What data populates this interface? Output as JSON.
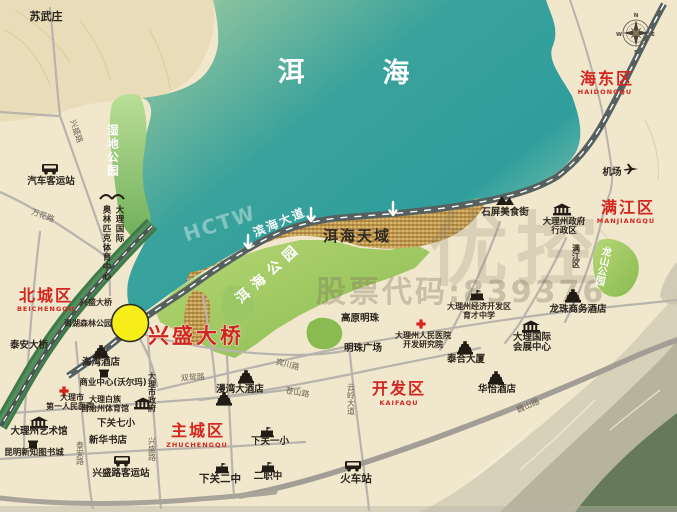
{
  "colors": {
    "district_red": "#d4261f",
    "lake_teal": "#2f9e9c",
    "park_green": "#8fbf5c",
    "marker_yellow": "#f7ee18",
    "highway_dark": "#55605f"
  },
  "lake": {
    "char1": "洱",
    "char2": "海"
  },
  "districts": {
    "haidong": {
      "name": "海东区",
      "pinyin": "HAIDONGQU"
    },
    "manjiang": {
      "name": "满江区",
      "pinyin": "MANJIANGQU"
    },
    "beicheng": {
      "name": "北城区",
      "pinyin": "BEICHENGQU"
    },
    "zhucheng": {
      "name": "主城区",
      "pinyin": "ZHUCHENGQU"
    },
    "kaifa": {
      "name": "开发区",
      "pinyin": "KAIFAQU"
    }
  },
  "parks": {
    "wetland": "湿地公园",
    "erhai_park": "洱海公园",
    "longshan": "龙山公园"
  },
  "highlight": {
    "bridge": "兴盛大桥",
    "erhai_tianyu": "洱海天域"
  },
  "roads": {
    "binhai_avenue": "滨海大道",
    "xingsheng_rd_n": "兴盛路",
    "wanhua_rd": "万花路",
    "taian_rd": "泰安路",
    "xingsheng_rd_s": "兴盛路",
    "shuangyuan_rd": "双鸳路",
    "binchuan_rd": "宾川路",
    "cangshan_rd": "苍山路",
    "yunling_ave": "云岭大道",
    "weishan_rd": "巍山路"
  },
  "pois": {
    "suwuzhuang": "苏武庄",
    "bus_station": "汽车客运站",
    "olympic_line1": "大理国际",
    "olympic_line2": "奥林匹克体育中心",
    "xingsheng_bridge_small": "兴盛大桥",
    "forest_park": "洱湖森林公园",
    "taian_bridge": "泰安大桥",
    "haiwan_hotel": "海湾酒店",
    "business_center": "商业中心(沃尔玛)",
    "hospital1_line1": "大理市",
    "hospital1_line2": "第一人民医院",
    "gym_line1": "大理白族",
    "gym_line2": "自治州体育馆",
    "city_gov": "大理市政府",
    "xiaguan_7th": "下关七小",
    "art_museum": "大理州艺术馆",
    "xinhua_bookstore": "新华书店",
    "book_city": "昆明新知图书城",
    "xingsheng_bus_station": "兴盛路客运站",
    "xiaguan_2nd": "下关二中",
    "xiaguan_1st": "下关一小",
    "erzhizhong": "二职中",
    "train_station": "火车站",
    "mingzhu_square": "明珠广场",
    "gaoyuan_mingzhu": "高原明珠",
    "hospital2_line1": "大理州人民医院",
    "hospital2_line2": "开发研究院",
    "edz_line1": "大理州经济开发区",
    "edz_line2": "育才中学",
    "expo_line1": "大理国际",
    "expo_line2": "会展中心",
    "taihe_tower": "泰合大厦",
    "huayi_hotel": "华怡酒店",
    "longzhu_hotel": "龙珠商务酒店",
    "shiping_food_street": "石屏美食街",
    "gov_line1": "大理州政府",
    "gov_line2": "行政区",
    "manjiang_small": "满江区",
    "airport": "机场",
    "manwan_hotel": "漫湾大酒店"
  },
  "watermark": {
    "stock_code": "股票代码:839376",
    "ghost_chars": "优控",
    "corner_mark": "HCTW"
  },
  "compass": {
    "north": "N",
    "south": "S",
    "east": "E",
    "west": "W"
  }
}
